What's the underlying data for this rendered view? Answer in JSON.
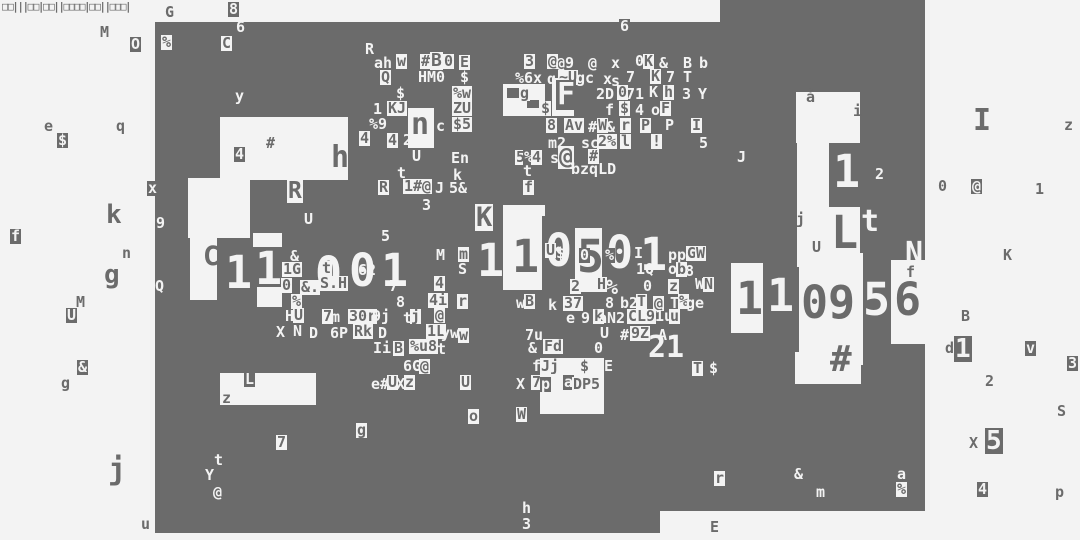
{
  "canvas": {
    "width": 1080,
    "height": 540,
    "colors": {
      "light": "#f3f3f3",
      "dark": "#6b6b6b"
    }
  },
  "top_strip": {
    "text": "□□|||□□|□□||□□□□|□□||□□□|",
    "x": 2,
    "y": 1
  },
  "blocks": {
    "dark": [
      [
        155,
        22,
        770,
        489
      ],
      [
        720,
        0,
        205,
        22
      ],
      [
        155,
        511,
        505,
        22
      ]
    ],
    "light": [
      [
        220,
        117,
        128,
        63
      ],
      [
        188,
        178,
        62,
        60
      ],
      [
        190,
        238,
        27,
        62
      ],
      [
        253,
        233,
        29,
        14
      ],
      [
        257,
        287,
        25,
        20
      ],
      [
        408,
        108,
        26,
        40
      ],
      [
        503,
        84,
        42,
        32
      ],
      [
        552,
        78,
        22,
        38
      ],
      [
        503,
        205,
        42,
        85
      ],
      [
        575,
        228,
        27,
        64
      ],
      [
        540,
        358,
        64,
        56
      ],
      [
        796,
        92,
        64,
        51
      ],
      [
        797,
        143,
        33,
        124
      ],
      [
        829,
        207,
        31,
        60
      ],
      [
        731,
        263,
        32,
        70
      ],
      [
        799,
        253,
        64,
        112
      ],
      [
        891,
        260,
        36,
        84
      ],
      [
        795,
        352,
        66,
        32
      ],
      [
        220,
        373,
        96,
        32
      ]
    ],
    "dark_overlay": [
      [
        542,
        216,
        33,
        74
      ],
      [
        829,
        143,
        31,
        64
      ],
      [
        507,
        88,
        12,
        10
      ],
      [
        527,
        100,
        12,
        8
      ]
    ]
  },
  "glyphs": [
    [
      165,
      5,
      "G",
      "d"
    ],
    [
      228,
      2,
      "8",
      "ld"
    ],
    [
      236,
      20,
      "6",
      "l"
    ],
    [
      100,
      25,
      "M",
      "d"
    ],
    [
      130,
      37,
      "O",
      "ld"
    ],
    [
      161,
      35,
      "%",
      "dl"
    ],
    [
      221,
      36,
      "C",
      "dl"
    ],
    [
      365,
      42,
      "R",
      "l"
    ],
    [
      235,
      89,
      "y",
      "l"
    ],
    [
      44,
      119,
      "e",
      "d"
    ],
    [
      57,
      133,
      "$",
      "ld"
    ],
    [
      116,
      119,
      "q",
      "d"
    ],
    [
      619,
      19,
      "6",
      "ld"
    ],
    [
      374,
      56,
      "ah",
      "l"
    ],
    [
      396,
      54,
      "w",
      "dl"
    ],
    [
      420,
      54,
      "#",
      "dl"
    ],
    [
      430,
      52,
      "B",
      "dl",
      1.2
    ],
    [
      443,
      54,
      "0",
      "dl"
    ],
    [
      459,
      55,
      "E",
      "dl"
    ],
    [
      380,
      70,
      "Q",
      "dl"
    ],
    [
      418,
      70,
      "HM0",
      "l"
    ],
    [
      460,
      70,
      "$",
      "l"
    ],
    [
      396,
      86,
      "$",
      "l"
    ],
    [
      452,
      86,
      "%w",
      "dl"
    ],
    [
      373,
      102,
      "1",
      "l"
    ],
    [
      387,
      101,
      "KJ",
      "dl"
    ],
    [
      452,
      101,
      "ZU",
      "dl"
    ],
    [
      369,
      117,
      "%9",
      "l"
    ],
    [
      410,
      110,
      "n",
      "dl",
      2
    ],
    [
      436,
      119,
      "c",
      "l"
    ],
    [
      452,
      117,
      "$5",
      "dl"
    ],
    [
      359,
      131,
      "4",
      "dl"
    ],
    [
      387,
      133,
      "4",
      "dl"
    ],
    [
      403,
      133,
      "2",
      "l"
    ],
    [
      412,
      149,
      "U",
      "l"
    ],
    [
      451,
      151,
      "En",
      "l"
    ],
    [
      397,
      166,
      "t",
      "l"
    ],
    [
      453,
      168,
      "k",
      "l"
    ],
    [
      378,
      180,
      "R",
      "dl"
    ],
    [
      403,
      179,
      "1#@",
      "dl"
    ],
    [
      435,
      181,
      "J",
      "l"
    ],
    [
      449,
      181,
      "5&",
      "l"
    ],
    [
      523,
      180,
      "f",
      "dl"
    ],
    [
      422,
      198,
      "3",
      "l"
    ],
    [
      304,
      212,
      "U",
      "l"
    ],
    [
      381,
      229,
      "5",
      "l"
    ],
    [
      287,
      180,
      "R",
      "dl",
      1.5
    ],
    [
      524,
      54,
      "3",
      "dl"
    ],
    [
      547,
      54,
      "@",
      "dl"
    ],
    [
      556,
      56,
      "@9",
      "l"
    ],
    [
      588,
      56,
      "@",
      "l"
    ],
    [
      611,
      56,
      "x",
      "l"
    ],
    [
      635,
      54,
      "0",
      "l"
    ],
    [
      643,
      54,
      "K",
      "dl"
    ],
    [
      659,
      56,
      "&",
      "l"
    ],
    [
      683,
      56,
      "B",
      "l"
    ],
    [
      699,
      56,
      "b",
      "l"
    ],
    [
      515,
      71,
      "%6x",
      "l"
    ],
    [
      547,
      72,
      "q",
      "l"
    ],
    [
      558,
      70,
      "~U",
      "dl"
    ],
    [
      576,
      71,
      "gc",
      "l"
    ],
    [
      603,
      72,
      "x",
      "l"
    ],
    [
      611,
      74,
      "s",
      "l"
    ],
    [
      626,
      70,
      "7",
      "l"
    ],
    [
      650,
      69,
      "K",
      "dl"
    ],
    [
      666,
      70,
      "7",
      "l"
    ],
    [
      683,
      70,
      "T",
      "l"
    ],
    [
      519,
      86,
      "g",
      "dl"
    ],
    [
      556,
      80,
      "F",
      "ld",
      2
    ],
    [
      596,
      87,
      "2D",
      "l"
    ],
    [
      617,
      85,
      "0",
      "dl"
    ],
    [
      626,
      87,
      "71",
      "l"
    ],
    [
      649,
      85,
      "K",
      "l"
    ],
    [
      663,
      85,
      "h",
      "dl"
    ],
    [
      682,
      87,
      "3",
      "l"
    ],
    [
      698,
      87,
      "Y",
      "l"
    ],
    [
      540,
      101,
      "$",
      "dl"
    ],
    [
      605,
      103,
      "f",
      "l"
    ],
    [
      619,
      101,
      "$",
      "dl"
    ],
    [
      635,
      103,
      "4",
      "l"
    ],
    [
      651,
      103,
      "o",
      "l"
    ],
    [
      660,
      101,
      "F",
      "dl"
    ],
    [
      546,
      118,
      "8",
      "dl"
    ],
    [
      564,
      118,
      "Av",
      "dl"
    ],
    [
      588,
      120,
      "#",
      "l"
    ],
    [
      597,
      118,
      "W",
      "dl"
    ],
    [
      606,
      120,
      "&",
      "l"
    ],
    [
      620,
      118,
      "r",
      "dl"
    ],
    [
      640,
      118,
      "P",
      "dl"
    ],
    [
      665,
      118,
      "P",
      "l"
    ],
    [
      691,
      118,
      "I",
      "dl"
    ],
    [
      548,
      136,
      "m2",
      "l"
    ],
    [
      581,
      136,
      "sc",
      "l"
    ],
    [
      597,
      134,
      "2%",
      "dl"
    ],
    [
      620,
      134,
      "l",
      "dl"
    ],
    [
      651,
      134,
      "!",
      "dl"
    ],
    [
      699,
      136,
      "5",
      "l"
    ],
    [
      515,
      150,
      "5",
      "dl"
    ],
    [
      523,
      150,
      "%",
      "ld"
    ],
    [
      531,
      150,
      "4",
      "dl"
    ],
    [
      550,
      151,
      "s",
      "l"
    ],
    [
      558,
      146,
      "@",
      "dl",
      1.5
    ],
    [
      588,
      149,
      "#",
      "dl"
    ],
    [
      523,
      164,
      "t",
      "l"
    ],
    [
      571,
      162,
      "bzqLD",
      "l"
    ],
    [
      266,
      136,
      "#",
      "d"
    ],
    [
      234,
      147,
      "4",
      "ld"
    ],
    [
      331,
      143,
      "h",
      "d",
      2
    ],
    [
      147,
      181,
      "x",
      "ld"
    ],
    [
      10,
      229,
      "f",
      "ld"
    ],
    [
      106,
      202,
      "k",
      "d",
      1.7
    ],
    [
      122,
      246,
      "n",
      "d"
    ],
    [
      104,
      262,
      "g",
      "d",
      1.7
    ],
    [
      155,
      279,
      "Q",
      "l"
    ],
    [
      156,
      216,
      "9",
      "l"
    ],
    [
      76,
      295,
      "M",
      "d"
    ],
    [
      66,
      308,
      "U",
      "ld"
    ],
    [
      77,
      360,
      "&",
      "ld"
    ],
    [
      61,
      376,
      "g",
      "d"
    ],
    [
      108,
      455,
      "j",
      "d",
      2
    ],
    [
      141,
      517,
      "u",
      "d"
    ],
    [
      203,
      243,
      "C",
      "d",
      1.8
    ],
    [
      225,
      250,
      "1",
      "l",
      3
    ],
    [
      255,
      246,
      "1",
      "l",
      3
    ],
    [
      290,
      249,
      "&",
      "l"
    ],
    [
      282,
      262,
      "1G",
      "dl"
    ],
    [
      281,
      278,
      "0",
      "dl"
    ],
    [
      300,
      280,
      "&.",
      "dl"
    ],
    [
      315,
      251,
      "0",
      "l",
      3
    ],
    [
      349,
      248,
      "0",
      "l",
      3
    ],
    [
      381,
      248,
      "1",
      "l",
      3
    ],
    [
      321,
      261,
      "t",
      "dl"
    ],
    [
      358,
      263,
      "62",
      "l"
    ],
    [
      319,
      276,
      "S.H",
      "dl"
    ],
    [
      389,
      279,
      "7",
      "l"
    ],
    [
      434,
      276,
      "4",
      "dl"
    ],
    [
      291,
      294,
      "%",
      "dl"
    ],
    [
      396,
      295,
      "8",
      "l"
    ],
    [
      428,
      293,
      "4i",
      "dl"
    ],
    [
      457,
      294,
      "r",
      "dl"
    ],
    [
      285,
      309,
      "H",
      "l"
    ],
    [
      293,
      308,
      "U",
      "dl"
    ],
    [
      322,
      309,
      "7",
      "dl"
    ],
    [
      331,
      310,
      "m",
      "l"
    ],
    [
      348,
      309,
      "30r",
      "dl"
    ],
    [
      372,
      309,
      "9j",
      "l"
    ],
    [
      403,
      311,
      "t",
      "l"
    ],
    [
      410,
      309,
      "j",
      "dl"
    ],
    [
      434,
      308,
      "@",
      "dl"
    ],
    [
      276,
      325,
      "X",
      "l"
    ],
    [
      293,
      324,
      "N",
      "l"
    ],
    [
      309,
      326,
      "D",
      "l"
    ],
    [
      330,
      326,
      "6P",
      "l"
    ],
    [
      353,
      324,
      "Rk",
      "dl"
    ],
    [
      378,
      326,
      "D",
      "l"
    ],
    [
      426,
      324,
      "1L",
      "dl"
    ],
    [
      441,
      326,
      "yw",
      "l"
    ],
    [
      458,
      328,
      "w",
      "dl"
    ],
    [
      373,
      341,
      "Ii",
      "l"
    ],
    [
      393,
      341,
      "B",
      "dl"
    ],
    [
      409,
      339,
      "%u8",
      "dl"
    ],
    [
      437,
      342,
      "t",
      "l"
    ],
    [
      436,
      248,
      "M",
      "l"
    ],
    [
      458,
      247,
      "m",
      "dl"
    ],
    [
      458,
      262,
      "S",
      "l"
    ],
    [
      475,
      204,
      "K",
      "dl",
      1.8
    ],
    [
      477,
      238,
      "1",
      "l",
      3
    ],
    [
      512,
      234,
      "1",
      "d",
      3
    ],
    [
      545,
      228,
      "0",
      "l",
      3
    ],
    [
      577,
      234,
      "5",
      "d",
      3
    ],
    [
      606,
      230,
      "0",
      "l",
      3
    ],
    [
      640,
      232,
      "1",
      "l",
      3
    ],
    [
      545,
      243,
      "U",
      "dl"
    ],
    [
      556,
      246,
      "$",
      "l"
    ],
    [
      579,
      248,
      "0",
      "ld"
    ],
    [
      604,
      248,
      "%",
      "ld"
    ],
    [
      634,
      246,
      "I",
      "l"
    ],
    [
      636,
      262,
      "1Q",
      "l"
    ],
    [
      668,
      248,
      "pp",
      "l"
    ],
    [
      686,
      246,
      "G",
      "dl"
    ],
    [
      695,
      246,
      "W",
      "dl"
    ],
    [
      668,
      262,
      "o",
      "l"
    ],
    [
      676,
      262,
      "b",
      "dl"
    ],
    [
      685,
      264,
      "8",
      "l"
    ],
    [
      570,
      279,
      "2",
      "dl"
    ],
    [
      596,
      277,
      "H",
      "dl"
    ],
    [
      606,
      277,
      "%",
      "l",
      1.3
    ],
    [
      643,
      279,
      "0",
      "l"
    ],
    [
      668,
      279,
      "z",
      "dl"
    ],
    [
      695,
      277,
      "W",
      "l"
    ],
    [
      703,
      277,
      "N",
      "dl"
    ],
    [
      516,
      296,
      "w",
      "l"
    ],
    [
      524,
      294,
      "B",
      "dl"
    ],
    [
      548,
      298,
      "k",
      "l"
    ],
    [
      563,
      296,
      "37",
      "dl"
    ],
    [
      605,
      296,
      "8",
      "l"
    ],
    [
      620,
      296,
      "b2",
      "l"
    ],
    [
      636,
      294,
      "T",
      "dl"
    ],
    [
      653,
      296,
      "@",
      "dl"
    ],
    [
      670,
      296,
      "T",
      "l"
    ],
    [
      678,
      294,
      "%",
      "dl"
    ],
    [
      686,
      296,
      "ge",
      "l"
    ],
    [
      566,
      311,
      "e",
      "l"
    ],
    [
      581,
      311,
      "9",
      "l"
    ],
    [
      593,
      309,
      "k",
      "dl"
    ],
    [
      598,
      311,
      "aN2",
      "l"
    ],
    [
      627,
      309,
      "CL9",
      "dl"
    ],
    [
      655,
      309,
      "1u",
      "l"
    ],
    [
      669,
      309,
      "u",
      "dl"
    ],
    [
      600,
      326,
      "U",
      "l"
    ],
    [
      620,
      328,
      "#6",
      "l"
    ],
    [
      630,
      326,
      "9Z",
      "dl"
    ],
    [
      658,
      328,
      "A",
      "l"
    ],
    [
      525,
      328,
      "7u",
      "l"
    ],
    [
      528,
      341,
      "&",
      "l"
    ],
    [
      543,
      339,
      "Fd",
      "dl"
    ],
    [
      594,
      341,
      "0",
      "l"
    ],
    [
      648,
      333,
      "21",
      "l",
      2
    ],
    [
      692,
      361,
      "T",
      "dl"
    ],
    [
      709,
      361,
      "$",
      "l"
    ],
    [
      403,
      359,
      "6G",
      "l"
    ],
    [
      419,
      359,
      "@",
      "dl"
    ],
    [
      371,
      377,
      "e#",
      "l"
    ],
    [
      387,
      375,
      "U",
      "dl"
    ],
    [
      396,
      377,
      "X",
      "l"
    ],
    [
      404,
      375,
      "z",
      "dl"
    ],
    [
      460,
      375,
      "U",
      "dl"
    ],
    [
      468,
      409,
      "o",
      "dl"
    ],
    [
      516,
      377,
      "X",
      "l"
    ],
    [
      531,
      375,
      "7",
      "dl"
    ],
    [
      540,
      377,
      "p",
      "ld"
    ],
    [
      532,
      359,
      "f",
      "l"
    ],
    [
      540,
      359,
      "Jj",
      "dl"
    ],
    [
      579,
      359,
      "$",
      "dl"
    ],
    [
      604,
      359,
      "E",
      "l"
    ],
    [
      563,
      375,
      "a",
      "ld"
    ],
    [
      572,
      377,
      "DP5",
      "dl"
    ],
    [
      516,
      407,
      "W",
      "dl"
    ],
    [
      522,
      501,
      "h",
      "l"
    ],
    [
      522,
      517,
      "3",
      "l"
    ],
    [
      710,
      520,
      "E",
      "d"
    ],
    [
      356,
      423,
      "g",
      "dl"
    ],
    [
      244,
      372,
      "L",
      "ld"
    ],
    [
      222,
      391,
      "z",
      "d"
    ],
    [
      276,
      435,
      "7",
      "dl"
    ],
    [
      214,
      453,
      "t",
      "l"
    ],
    [
      205,
      468,
      "Y",
      "l"
    ],
    [
      213,
      485,
      "@",
      "l"
    ],
    [
      737,
      150,
      "J",
      "l"
    ],
    [
      833,
      149,
      "1",
      "l",
      3
    ],
    [
      875,
      167,
      "2",
      "l"
    ],
    [
      806,
      90,
      "å",
      "d"
    ],
    [
      853,
      104,
      "i",
      "d"
    ],
    [
      796,
      212,
      "j",
      "d"
    ],
    [
      812,
      240,
      "U",
      "d"
    ],
    [
      831,
      210,
      "L",
      "d",
      3
    ],
    [
      861,
      207,
      "t",
      "l",
      2
    ],
    [
      905,
      239,
      "N",
      "l",
      2
    ],
    [
      736,
      276,
      "1",
      "d",
      3
    ],
    [
      767,
      273,
      "1",
      "l",
      3
    ],
    [
      801,
      280,
      "0",
      "d",
      3
    ],
    [
      828,
      280,
      "9",
      "d",
      3
    ],
    [
      863,
      277,
      "5",
      "l",
      3
    ],
    [
      894,
      277,
      "6",
      "d",
      3
    ],
    [
      906,
      265,
      "f",
      "d"
    ],
    [
      830,
      342,
      "#",
      "d",
      2.4
    ],
    [
      714,
      471,
      "r",
      "dl"
    ],
    [
      794,
      467,
      "&",
      "l"
    ],
    [
      816,
      485,
      "m",
      "l"
    ],
    [
      897,
      467,
      "a",
      "l"
    ],
    [
      896,
      482,
      "%",
      "dl"
    ],
    [
      973,
      106,
      "I",
      "d",
      2
    ],
    [
      1064,
      118,
      "z",
      "d"
    ],
    [
      938,
      179,
      "0",
      "d"
    ],
    [
      971,
      179,
      "@",
      "ld"
    ],
    [
      1035,
      182,
      "1",
      "d"
    ],
    [
      1003,
      248,
      "K",
      "d"
    ],
    [
      961,
      309,
      "B",
      "d"
    ],
    [
      945,
      341,
      "d",
      "d"
    ],
    [
      954,
      336,
      "1",
      "ld",
      1.7
    ],
    [
      1025,
      341,
      "v",
      "ld"
    ],
    [
      1067,
      356,
      "3",
      "ld"
    ],
    [
      985,
      374,
      "2",
      "d"
    ],
    [
      1057,
      404,
      "S",
      "d"
    ],
    [
      969,
      436,
      "X",
      "d"
    ],
    [
      985,
      428,
      "5",
      "ld",
      1.7
    ],
    [
      977,
      482,
      "4",
      "ld"
    ],
    [
      1055,
      485,
      "p",
      "d"
    ]
  ]
}
